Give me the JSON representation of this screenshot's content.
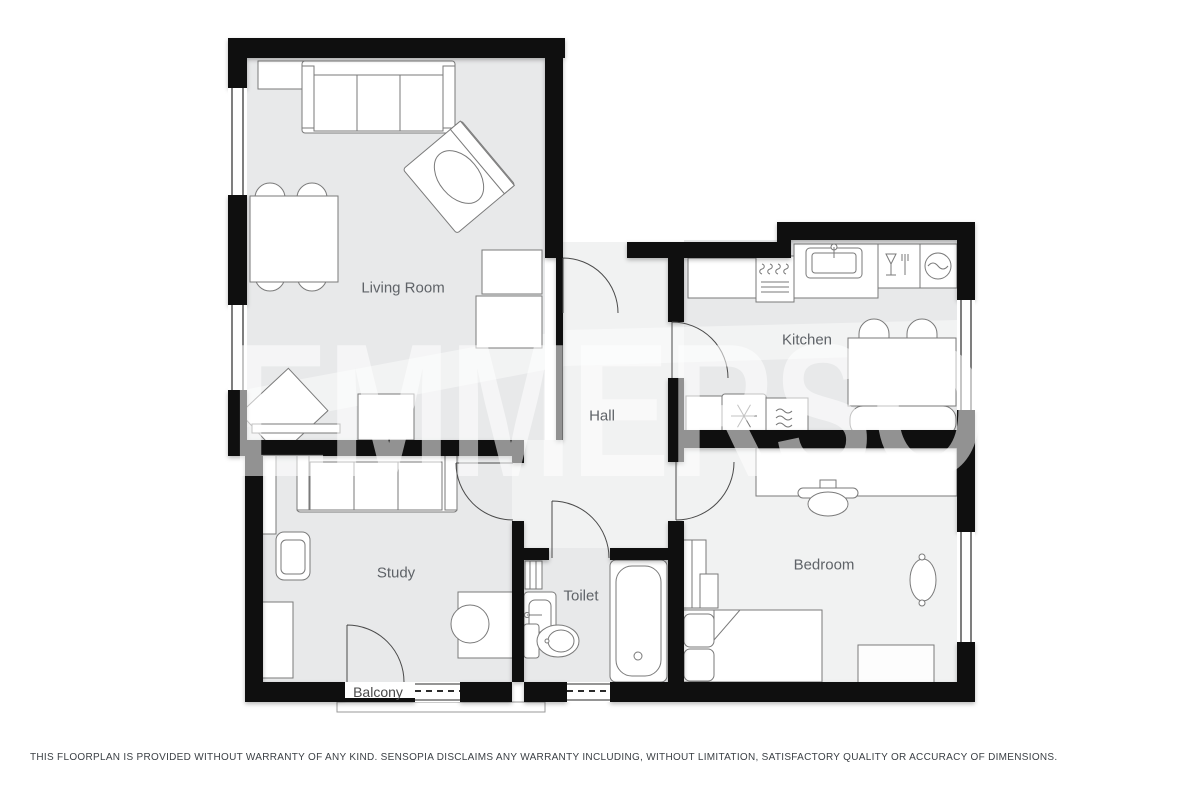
{
  "floorplan": {
    "watermark_text": "EMMERSON",
    "rooms": [
      {
        "label": "Living Room"
      },
      {
        "label": "Kitchen"
      },
      {
        "label": "Hall"
      },
      {
        "label": "Study"
      },
      {
        "label": "Toilet"
      },
      {
        "label": "Bedroom"
      },
      {
        "label": "Balcony"
      }
    ],
    "icons": [
      "stove-burners-icon",
      "kitchen-sink-icon",
      "dishwasher-glass-fork-icon",
      "washing-machine-icon",
      "fridge-snowflake-icon",
      "oven-waves-icon",
      "toilet-wc-icon",
      "bathtub-icon",
      "radiator-icon"
    ],
    "disclaimer": "THIS FLOORPLAN IS PROVIDED WITHOUT WARRANTY OF ANY KIND. SENSOPIA DISCLAIMS ANY WARRANTY INCLUDING, WITHOUT LIMITATION, SATISFACTORY QUALITY OR ACCURACY OF DIMENSIONS.",
    "colors": {
      "wall": "#0f0f0f",
      "room_fill": "#e8e9ea",
      "hall_fill": "#f1f2f2",
      "label_text": "#5f6368",
      "furniture_stroke": "#7a7a7a",
      "watermark": "rgba(255,255,255,0.55)"
    }
  }
}
